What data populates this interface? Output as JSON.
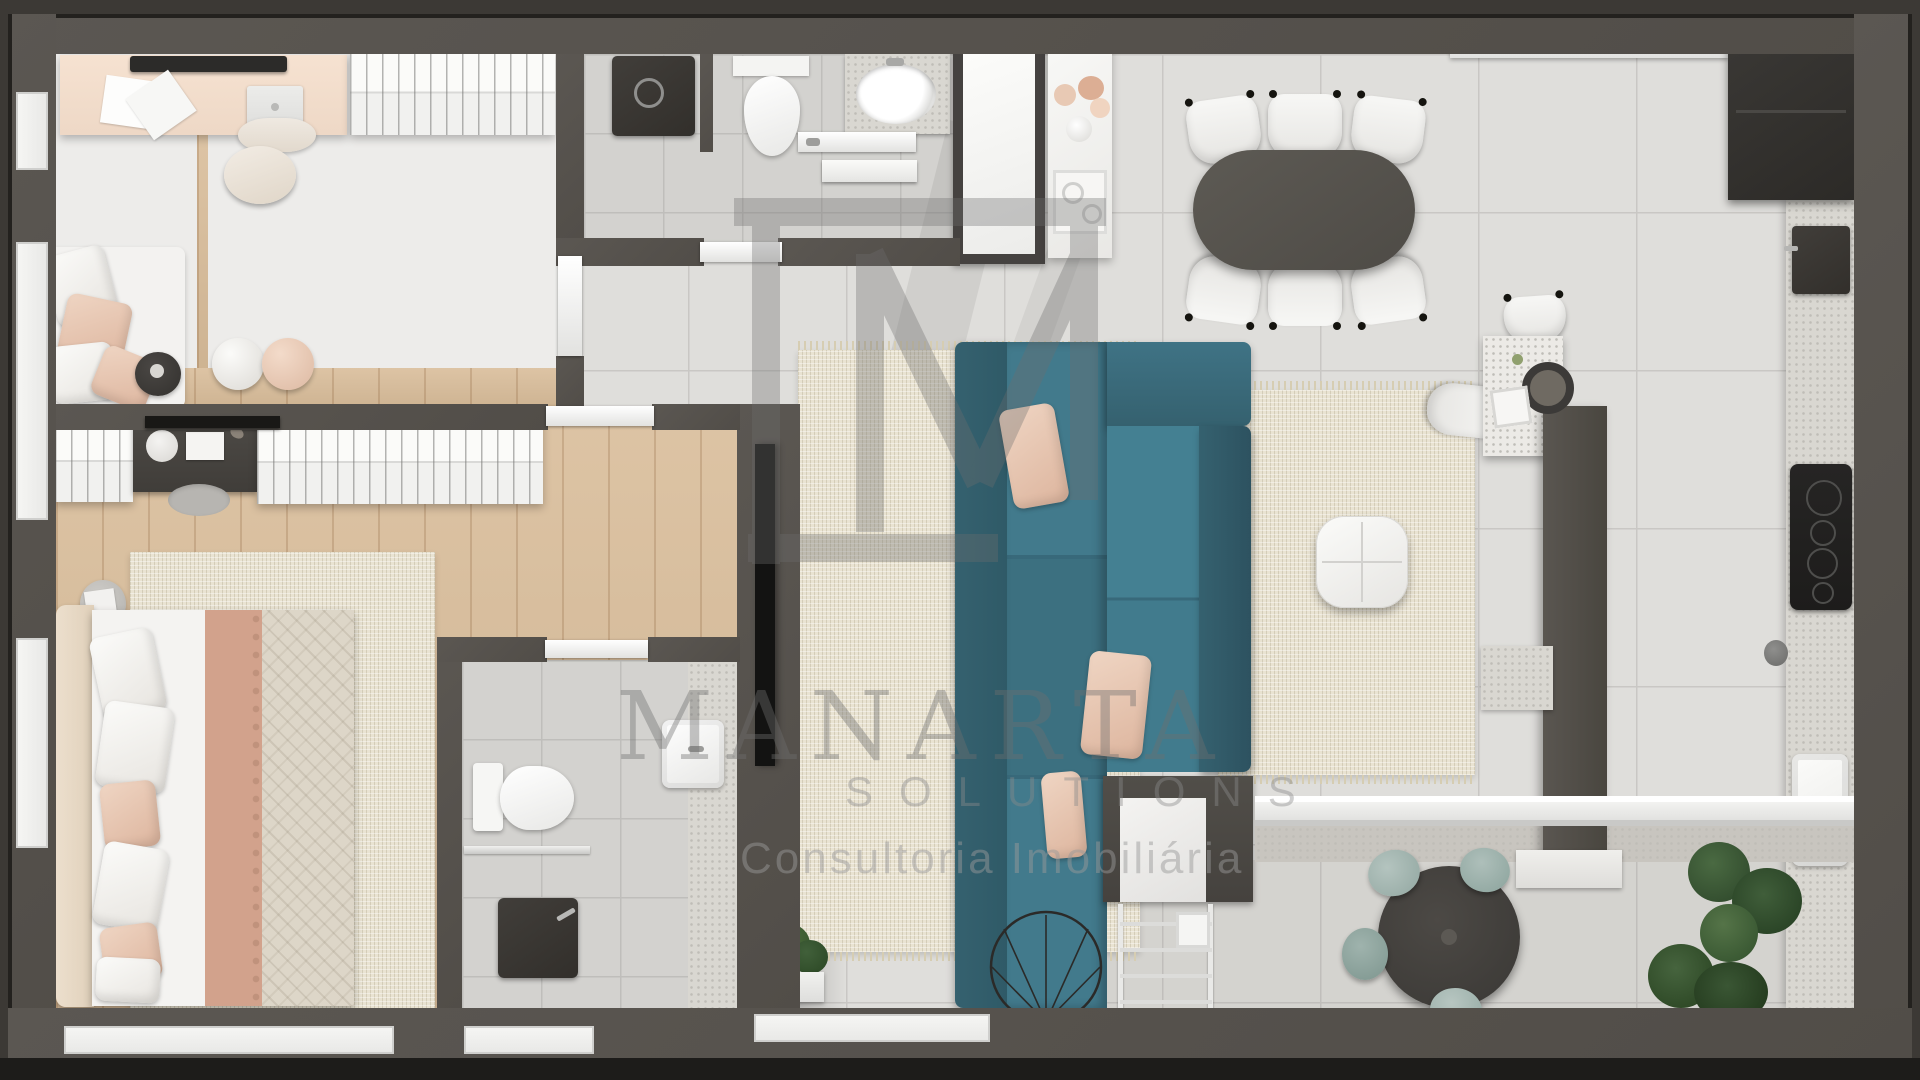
{
  "watermark": {
    "brand": "MANARTA",
    "tagline": "SOLUTIONS",
    "subtitle": "Consultoria Imobiliária"
  },
  "palette": {
    "wall": "#57534e",
    "wall-deep": "#3c3935",
    "tile": "#dfdedb",
    "wood": "#d9bd9a",
    "rug": "#e9e3d2",
    "sofa": "#427a8c",
    "sofa-dark": "#35616f",
    "blush": "#e6c8b4",
    "white-furn": "#f4f3f1",
    "counter": "#d9d7d1",
    "appliance": "#2b2a28",
    "table-dark": "#56534d",
    "terr-chair": "#a2b5b0",
    "plant": "#3a5434",
    "wm": "#6f6f6f"
  }
}
